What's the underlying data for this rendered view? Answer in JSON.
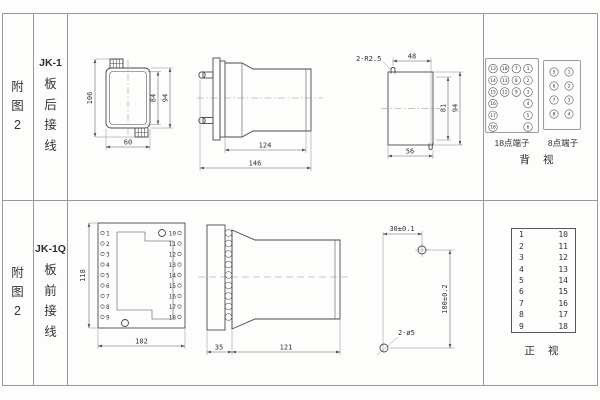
{
  "row1": {
    "fig_label": "附图2",
    "model": "JK-1",
    "wiring_type": "板后接线",
    "front_view": {
      "dim_height": "106",
      "dim_inner_height": "84",
      "dim_outer_height": "94",
      "dim_width": "60"
    },
    "side_view": {
      "dim_body_depth": "124",
      "dim_total_depth": "146"
    },
    "panel_cutout": {
      "corner_note": "2-R2.5",
      "dim_slot_span": "48",
      "dim_inner_height": "81",
      "dim_outer_height": "94",
      "dim_width": "56"
    },
    "terminal18": {
      "caption": "18点端子",
      "grid": [
        [
          "13",
          "10",
          "7",
          "1"
        ],
        [
          "14",
          "11",
          "8",
          "2"
        ],
        [
          "15",
          "12",
          "9",
          "3"
        ],
        [
          "16",
          "",
          "",
          "4"
        ],
        [
          "17",
          "",
          "",
          "5"
        ],
        [
          "18",
          "",
          "",
          "6"
        ]
      ]
    },
    "terminal8": {
      "caption": "8点端子",
      "grid": [
        [
          "5",
          "1"
        ],
        [
          "6",
          "2"
        ],
        [
          "7",
          "3"
        ],
        [
          "8",
          "4"
        ]
      ]
    },
    "view_caption": "背 视"
  },
  "row2": {
    "fig_label": "附图2",
    "model": "JK-1Q",
    "wiring_type": "板前接线",
    "front_view": {
      "dim_height": "118",
      "dim_width": "102",
      "left_terminals": [
        "1",
        "2",
        "3",
        "4",
        "5",
        "6",
        "7",
        "8",
        "9"
      ],
      "right_terminals": [
        "10",
        "11",
        "12",
        "13",
        "14",
        "15",
        "16",
        "17",
        "18"
      ]
    },
    "side_view": {
      "dim_flange": "35",
      "dim_body": "121"
    },
    "drill_view": {
      "dim_horizontal": "30±0.1",
      "dim_vertical": "100±0.2",
      "hole_note": "2-ø5"
    },
    "terminal_table": {
      "left": [
        "1",
        "2",
        "3",
        "4",
        "5",
        "6",
        "7",
        "8",
        "9"
      ],
      "right": [
        "10",
        "11",
        "12",
        "13",
        "14",
        "15",
        "16",
        "17",
        "18"
      ],
      "caption": "正 视"
    }
  }
}
